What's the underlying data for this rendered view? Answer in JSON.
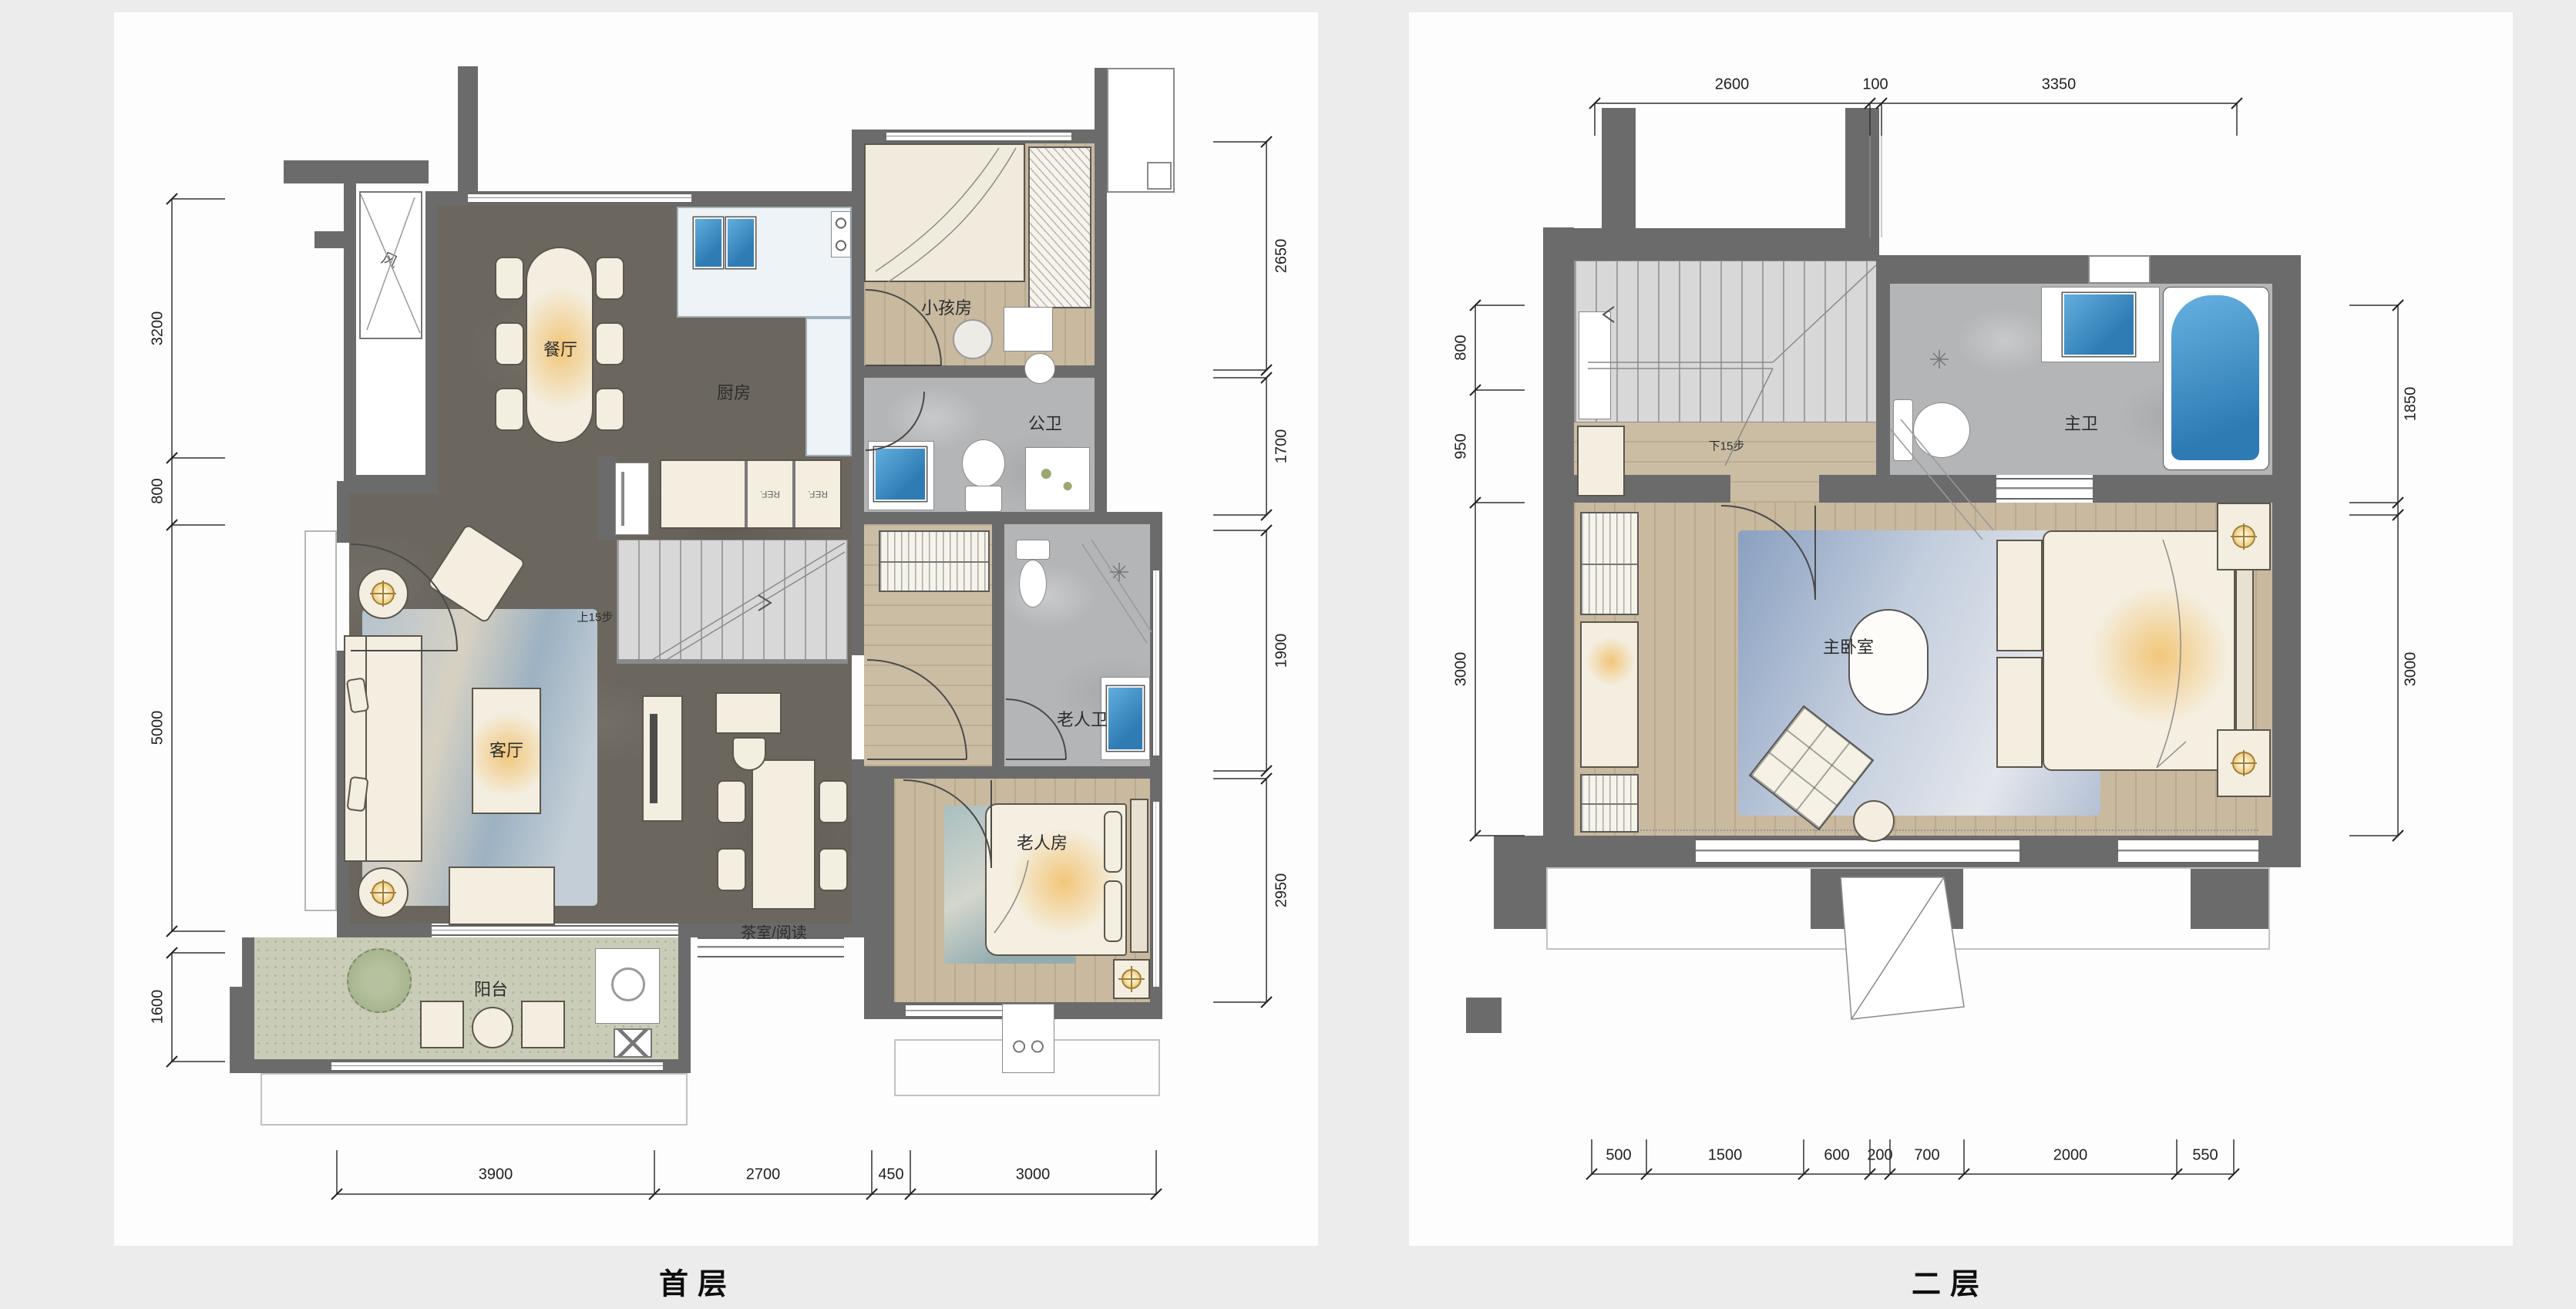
{
  "plans": [
    {
      "title": "首层",
      "rooms": {
        "dining": "餐厅",
        "kitchen": "厨房",
        "kids": "小孩房",
        "public_bath": "公卫",
        "stairs_up": "上15步",
        "elder_bath": "老人卫",
        "living": "客厅",
        "tea": "茶室/阅读",
        "elder_room": "老人房",
        "balcony": "阳台",
        "shaft": "风"
      },
      "appliances": {
        "fridge1": "REF.",
        "fridge2": "REF."
      },
      "dims": {
        "left": [
          "3200",
          "800",
          "5000",
          "1600"
        ],
        "right": [
          "2650",
          "1700",
          "1900",
          "2950"
        ],
        "bottom": [
          "3900",
          "2700",
          "450",
          "3000"
        ]
      }
    },
    {
      "title": "二层",
      "rooms": {
        "stairs_down": "下15步",
        "master_bath": "主卫",
        "master_bedroom": "主卧室"
      },
      "dims": {
        "top": [
          "2600",
          "100",
          "3350"
        ],
        "left": [
          "800",
          "950",
          "3000"
        ],
        "right": [
          "1850",
          "3000"
        ],
        "bottom": [
          "500",
          "1500",
          "600",
          "200",
          "700",
          "2000",
          "550"
        ]
      }
    }
  ],
  "colors": {
    "wall": "#6b6b6b",
    "marble_floor": "#6c675e",
    "wood_floor": "#c8b99f",
    "bath_floor": "#b4b5b7",
    "balcony_floor": "#c9ccb7",
    "water": "#3a8ec9",
    "warm_glow": "#f0c474",
    "rug_blue": "#9db1c6"
  }
}
